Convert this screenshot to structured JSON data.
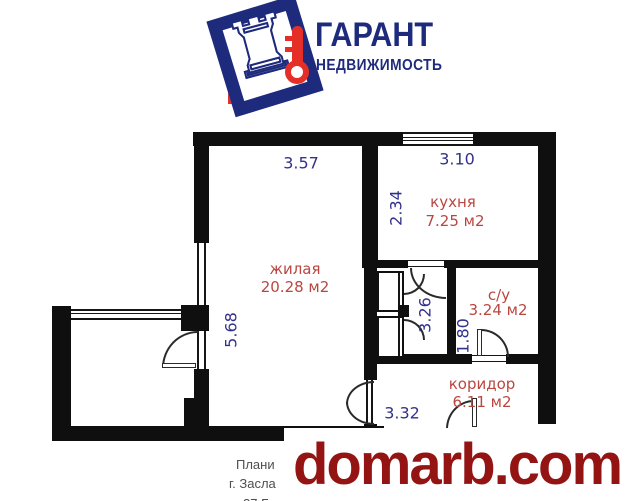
{
  "logo": {
    "title": "ГАРАНТ",
    "subtitle": "НЕДВИЖИМОСТЬ",
    "rook_glyph": "♜",
    "brand_navy": "#1e2b7d",
    "brand_red": "#e62e28"
  },
  "plan": {
    "type": "apartment-floor-plan",
    "rooms": [
      {
        "name": "жилая",
        "area": "20.28 м2"
      },
      {
        "name": "кухня",
        "area": "7.25 м2"
      },
      {
        "name": "с/у",
        "area": "3.24 м2"
      },
      {
        "name": "коридор",
        "area": "6.11 м2"
      }
    ],
    "dimensions": [
      {
        "value": "3.57",
        "orientation": "horizontal",
        "edge": "living-top"
      },
      {
        "value": "3.10",
        "orientation": "horizontal",
        "edge": "kitchen-top"
      },
      {
        "value": "2.34",
        "orientation": "vertical",
        "edge": "kitchen-left"
      },
      {
        "value": "5.68",
        "orientation": "vertical",
        "edge": "living-left"
      },
      {
        "value": "3.26",
        "orientation": "vertical",
        "edge": "corridor-strip"
      },
      {
        "value": "1.80",
        "orientation": "vertical",
        "edge": "bathroom-left"
      },
      {
        "value": "3.32",
        "orientation": "horizontal",
        "edge": "corridor-bottom"
      }
    ],
    "dim_color": "#32328c",
    "room_color": "#ba4640",
    "wall_color": "#0f0f0f"
  },
  "footer": {
    "line1": "Плани",
    "line2": "г. Засла",
    "line3": "27 Б"
  },
  "watermark": {
    "text": "domarb.com",
    "color": "#941414"
  }
}
